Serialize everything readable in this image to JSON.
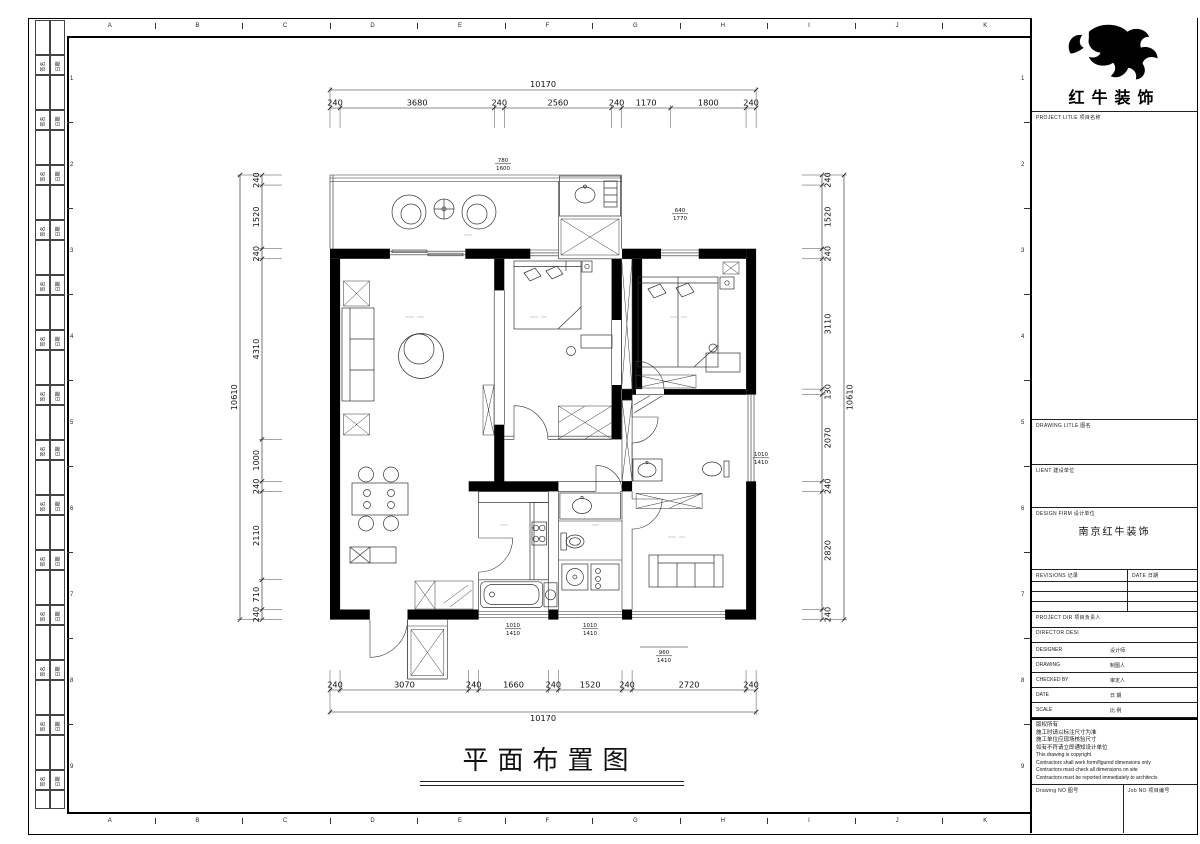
{
  "sheet": {
    "grid_letters": [
      "A",
      "B",
      "C",
      "D",
      "E",
      "F",
      "G",
      "H",
      "I",
      "J",
      "K"
    ],
    "grid_numbers": [
      "1",
      "2",
      "3",
      "4",
      "5",
      "6",
      "7",
      "8",
      "9"
    ],
    "signoff_left": "签名",
    "signoff_right": "日期"
  },
  "title_block": {
    "company": "红牛装饰",
    "project_label": "PROJECT LITLE  项目名称",
    "drawing_label": "DRAWING LITLE  图名",
    "client_label": "LIENT  建设单位",
    "firm_label": "DESIGN FIRM  设计单位",
    "firm_value": "南京红牛装饰",
    "revisions_label": "REVISIONS  记录",
    "date_col_label": "DATE  日期",
    "project_dir_label": "PROJECT DIR   项目负责人",
    "director_label": "DIRECTOR DESI",
    "staff_rows": [
      {
        "en": "DESIGNER",
        "zh": "设计师"
      },
      {
        "en": "DRAWING",
        "zh": "制图人"
      },
      {
        "en": "CHECKED BY",
        "zh": "审定人"
      },
      {
        "en": "DATE",
        "zh": "日  期"
      },
      {
        "en": "SCALE",
        "zh": "比  例"
      }
    ],
    "copyright_lines_zh": [
      "版权所有",
      "施工时请以标注尺寸为准",
      "施工单位应现场核验尺寸",
      "如有不符请立即通知设计单位"
    ],
    "copyright_lines_en": [
      "This drawing is copyright",
      "Contractors shall work form/figured dimensions only",
      "Contractors must check all dimensions on site",
      "Contractors must be reported immediately to architects"
    ],
    "drawing_no_label": "Drawing NO  图号",
    "job_no_label": "Job NO  项目编号"
  },
  "drawing": {
    "title": "平面布置图",
    "dimensions": {
      "top": {
        "total": "10170",
        "segments": [
          "240",
          "3680",
          "240",
          "2560",
          "240",
          "1170",
          "1800",
          "240"
        ]
      },
      "bottom": {
        "total": "10170",
        "segments": [
          "240",
          "3070",
          "240",
          "1660",
          "240",
          "1520",
          "240",
          "2720",
          "240"
        ]
      },
      "left": {
        "total": "10610",
        "segments": [
          "240",
          "1520",
          "240",
          "4310",
          "1000",
          "240",
          "2110",
          "710",
          "240"
        ]
      },
      "right": {
        "total": "10610",
        "segments": [
          "240",
          "1520",
          "240",
          "3110",
          "130",
          "2070",
          "240",
          "2820",
          "240"
        ]
      }
    },
    "window_tags": [
      {
        "top": "780",
        "bottom": "1600"
      },
      {
        "top": "640",
        "bottom": "1770"
      },
      {
        "top": "1010",
        "bottom": "1410"
      },
      {
        "top": "1010",
        "bottom": "1410"
      },
      {
        "top": "960",
        "bottom": "1410"
      },
      {
        "top": "1010",
        "bottom": "1410"
      }
    ]
  }
}
